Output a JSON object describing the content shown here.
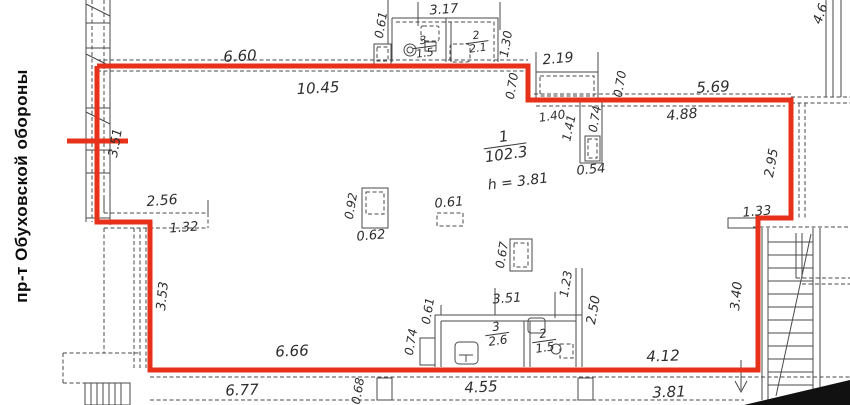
{
  "street_label": "пр-т Обуховской обороны",
  "colors": {
    "boundary": "#e8311a",
    "wall": "#4a4a4a",
    "background": "#ffffff",
    "text": "#2e2e2e"
  },
  "main_room": {
    "number": "1",
    "area": "102.3",
    "height": "h = 3.81"
  },
  "rooms": [
    {
      "id": "top-wc-left",
      "number": "3",
      "area": "1.5"
    },
    {
      "id": "top-wc-right",
      "number": "2",
      "area": "2.1"
    },
    {
      "id": "bottom-wc-left",
      "number": "3",
      "area": "2.6"
    },
    {
      "id": "bottom-wc-right",
      "number": "2",
      "area": "1.5"
    }
  ],
  "dimensions": [
    {
      "text": "6.60",
      "x": 240,
      "y": 56,
      "rot": -3,
      "size": 15
    },
    {
      "text": "10.45",
      "x": 318,
      "y": 88,
      "rot": -3,
      "size": 15
    },
    {
      "text": "0.61",
      "x": 381,
      "y": 25,
      "rot": -80,
      "size": 12
    },
    {
      "text": "3.17",
      "x": 444,
      "y": 10,
      "rot": -4,
      "size": 13
    },
    {
      "text": "1.30",
      "x": 506,
      "y": 44,
      "rot": -80,
      "size": 12
    },
    {
      "text": "2.19",
      "x": 558,
      "y": 59,
      "rot": -5,
      "size": 14
    },
    {
      "text": "0.70",
      "x": 512,
      "y": 86,
      "rot": -80,
      "size": 12
    },
    {
      "text": "0.70",
      "x": 620,
      "y": 84,
      "rot": -80,
      "size": 12
    },
    {
      "text": "5.69",
      "x": 713,
      "y": 87,
      "rot": -3,
      "size": 15
    },
    {
      "text": "4.88",
      "x": 682,
      "y": 115,
      "rot": -5,
      "size": 14
    },
    {
      "text": "1.40",
      "x": 552,
      "y": 116,
      "rot": -8,
      "size": 12
    },
    {
      "text": "1.41",
      "x": 569,
      "y": 128,
      "rot": -78,
      "size": 12
    },
    {
      "text": "0.74",
      "x": 595,
      "y": 119,
      "rot": -80,
      "size": 12
    },
    {
      "text": "0.54",
      "x": 591,
      "y": 170,
      "rot": -5,
      "size": 13
    },
    {
      "text": "4.6",
      "x": 821,
      "y": 14,
      "rot": -70,
      "size": 13
    },
    {
      "text": "3.51",
      "x": 116,
      "y": 143,
      "rot": -80,
      "size": 13
    },
    {
      "text": "2.56",
      "x": 162,
      "y": 201,
      "rot": -4,
      "size": 14
    },
    {
      "text": "1.32",
      "x": 184,
      "y": 228,
      "rot": -4,
      "size": 13
    },
    {
      "text": "0.92",
      "x": 351,
      "y": 206,
      "rot": -80,
      "size": 12
    },
    {
      "text": "0.62",
      "x": 371,
      "y": 236,
      "rot": -5,
      "size": 13
    },
    {
      "text": "0.61",
      "x": 449,
      "y": 203,
      "rot": -5,
      "size": 13
    },
    {
      "text": "0.67",
      "x": 502,
      "y": 255,
      "rot": -80,
      "size": 12
    },
    {
      "text": "2.95",
      "x": 772,
      "y": 163,
      "rot": -80,
      "size": 13
    },
    {
      "text": "1.33",
      "x": 757,
      "y": 212,
      "rot": -5,
      "size": 13
    },
    {
      "text": "3.53",
      "x": 163,
      "y": 296,
      "rot": -84,
      "size": 13
    },
    {
      "text": "0.61",
      "x": 428,
      "y": 311,
      "rot": -80,
      "size": 12
    },
    {
      "text": "0.74",
      "x": 411,
      "y": 342,
      "rot": -80,
      "size": 12
    },
    {
      "text": "3.51",
      "x": 507,
      "y": 299,
      "rot": -4,
      "size": 13
    },
    {
      "text": "1.23",
      "x": 566,
      "y": 284,
      "rot": -80,
      "size": 12
    },
    {
      "text": "2.50",
      "x": 594,
      "y": 310,
      "rot": -80,
      "size": 13
    },
    {
      "text": "3.40",
      "x": 737,
      "y": 296,
      "rot": -84,
      "size": 13
    },
    {
      "text": "6.66",
      "x": 292,
      "y": 351,
      "rot": -2,
      "size": 15
    },
    {
      "text": "4.12",
      "x": 663,
      "y": 356,
      "rot": -2,
      "size": 15
    },
    {
      "text": "6.77",
      "x": 242,
      "y": 390,
      "rot": -2,
      "size": 15
    },
    {
      "text": "4.55",
      "x": 481,
      "y": 387,
      "rot": -3,
      "size": 15
    },
    {
      "text": "3.81",
      "x": 669,
      "y": 392,
      "rot": -2,
      "size": 15
    },
    {
      "text": "0.68",
      "x": 358,
      "y": 391,
      "rot": -80,
      "size": 12
    }
  ]
}
